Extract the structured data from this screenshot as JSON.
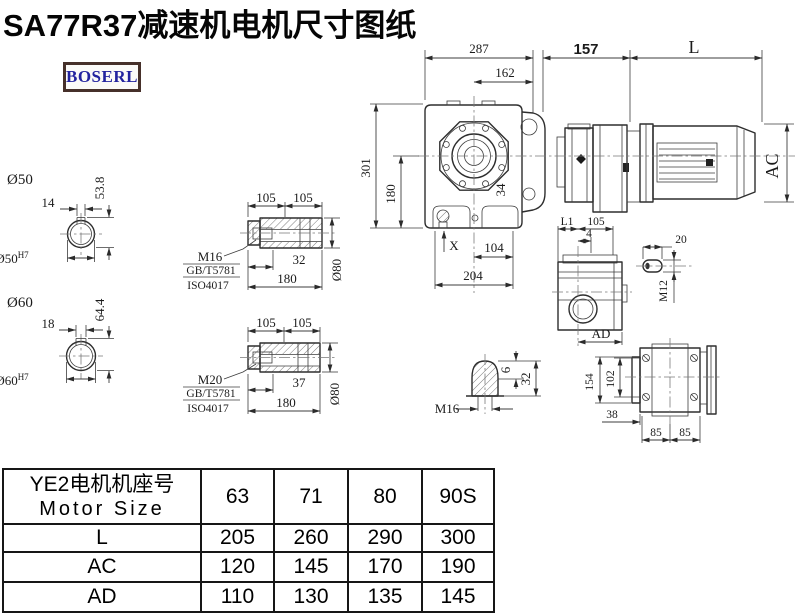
{
  "title": "SA77R37减速机电机尺寸图纸",
  "logo": {
    "text": "BOSERL",
    "text_color": "#23239f",
    "border_color": "#46302a"
  },
  "drawing": {
    "top": {
      "d287": "287",
      "d162": "162",
      "d157": "157",
      "dl": "L"
    },
    "left": {
      "d301": "301",
      "d180": "180"
    },
    "bottom": {
      "dx": "X",
      "d104": "104",
      "d204": "204",
      "d34": "34"
    },
    "motor": {
      "dac": "AC"
    },
    "section50": {
      "title": "Ø50",
      "key": "14",
      "h": "53.8",
      "bore": "Ø50",
      "tol": "H7"
    },
    "section60": {
      "title": "Ø60",
      "key": "18",
      "h": "64.4",
      "bore": "Ø60",
      "tol": "H7"
    },
    "shaft1": {
      "p1": "105",
      "p2": "105",
      "thread": "M16",
      "std1": "GB/T5781",
      "std2": "ISO4017",
      "len": "32",
      "total": "180",
      "dia": "Ø80"
    },
    "shaft2": {
      "p1": "105",
      "p2": "105",
      "thread": "M20",
      "std1": "GB/T5781",
      "std2": "ISO4017",
      "len": "37",
      "total": "180",
      "dia": "Ø80"
    },
    "plug": {
      "thread": "M16",
      "d6": "6",
      "d32": "32"
    },
    "side": {
      "l1": "L1",
      "d105": "105",
      "d4": "4",
      "ad": "AD"
    },
    "key": {
      "d20": "20",
      "thread": "M12"
    },
    "back": {
      "d154": "154",
      "d102": "102",
      "d38": "38",
      "d85a": "85",
      "d85b": "85"
    }
  },
  "table": {
    "header": {
      "cn": "YE2电机机座号",
      "en": "Motor Size"
    },
    "columns": [
      "63",
      "71",
      "80",
      "90S"
    ],
    "rows": [
      {
        "label": "L",
        "values": [
          "205",
          "260",
          "290",
          "300"
        ]
      },
      {
        "label": "AC",
        "values": [
          "120",
          "145",
          "170",
          "190"
        ]
      },
      {
        "label": "AD",
        "values": [
          "110",
          "130",
          "135",
          "145"
        ]
      }
    ]
  }
}
